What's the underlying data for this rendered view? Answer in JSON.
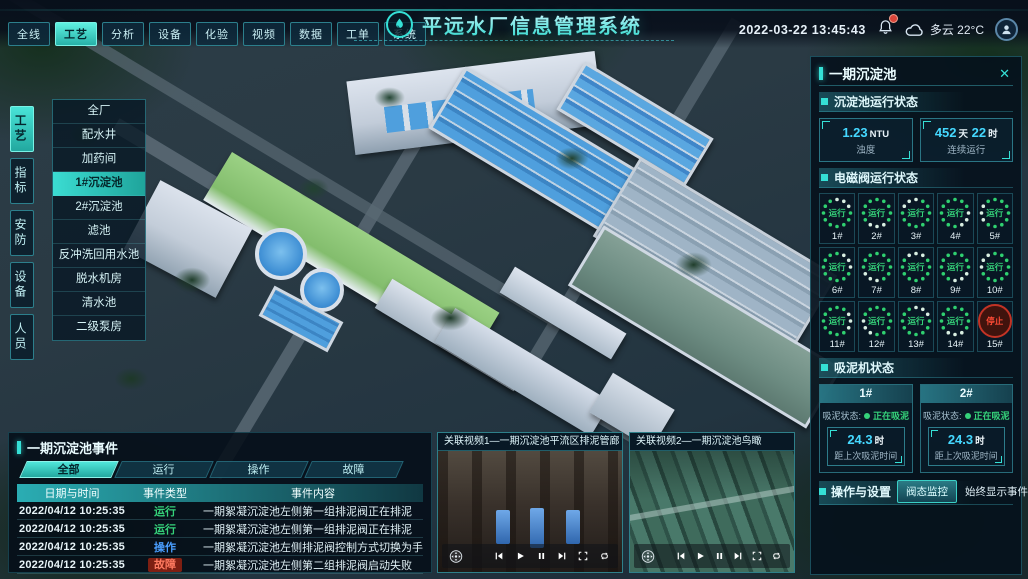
{
  "header": {
    "title": "平远水厂信息管理系统",
    "datetime": "2022-03-22 13:45:43",
    "weather": "多云 22°C",
    "nav_tabs": [
      {
        "label": "全线",
        "active": false
      },
      {
        "label": "工艺",
        "active": true
      },
      {
        "label": "分析",
        "active": false
      },
      {
        "label": "设备",
        "active": false
      },
      {
        "label": "化验",
        "active": false
      },
      {
        "label": "视频",
        "active": false
      },
      {
        "label": "数据",
        "active": false
      },
      {
        "label": "工单",
        "active": false
      },
      {
        "label": "系统",
        "active": false
      }
    ]
  },
  "sidebar": {
    "tabs": [
      {
        "label": "工艺",
        "active": true
      },
      {
        "label": "指标",
        "active": false
      },
      {
        "label": "安防",
        "active": false
      },
      {
        "label": "设备",
        "active": false
      },
      {
        "label": "人员",
        "active": false
      }
    ],
    "menu": [
      {
        "label": "全厂",
        "active": false
      },
      {
        "label": "配水井",
        "active": false
      },
      {
        "label": "加药间",
        "active": false
      },
      {
        "label": "1#沉淀池",
        "active": true
      },
      {
        "label": "2#沉淀池",
        "active": false
      },
      {
        "label": "滤池",
        "active": false
      },
      {
        "label": "反冲洗回用水池",
        "active": false
      },
      {
        "label": "脱水机房",
        "active": false
      },
      {
        "label": "清水池",
        "active": false
      },
      {
        "label": "二级泵房",
        "active": false
      }
    ]
  },
  "right_panel": {
    "title": "一期沉淀池",
    "close_glyph": "✕",
    "running_status": {
      "title": "沉淀池运行状态",
      "cards": [
        {
          "value": "1.23",
          "unit": "NTU",
          "label": "浊度"
        },
        {
          "value": "452",
          "unit": "天",
          "value2": "22",
          "unit2": "时",
          "label": "连续运行"
        }
      ]
    },
    "valves": {
      "title": "电磁阀运行状态",
      "items": [
        {
          "id": "1#",
          "status": "运行",
          "state": "running"
        },
        {
          "id": "2#",
          "status": "运行",
          "state": "running"
        },
        {
          "id": "3#",
          "status": "运行",
          "state": "running"
        },
        {
          "id": "4#",
          "status": "运行",
          "state": "running"
        },
        {
          "id": "5#",
          "status": "运行",
          "state": "running"
        },
        {
          "id": "6#",
          "status": "运行",
          "state": "running"
        },
        {
          "id": "7#",
          "status": "运行",
          "state": "running"
        },
        {
          "id": "8#",
          "status": "运行",
          "state": "running"
        },
        {
          "id": "9#",
          "status": "运行",
          "state": "running"
        },
        {
          "id": "10#",
          "status": "运行",
          "state": "running"
        },
        {
          "id": "11#",
          "status": "运行",
          "state": "running"
        },
        {
          "id": "12#",
          "status": "运行",
          "state": "running"
        },
        {
          "id": "13#",
          "status": "运行",
          "state": "running"
        },
        {
          "id": "14#",
          "status": "运行",
          "state": "running"
        },
        {
          "id": "15#",
          "status": "停止",
          "state": "stopped"
        }
      ]
    },
    "sludge": {
      "title": "吸泥机状态",
      "status_label": "吸泥状态:",
      "machines": [
        {
          "id": "1#",
          "status": "正在吸泥",
          "value": "24.3",
          "unit": "时",
          "caption": "距上次吸泥时间"
        },
        {
          "id": "2#",
          "status": "正在吸泥",
          "value": "24.3",
          "unit": "时",
          "caption": "距上次吸泥时间"
        }
      ]
    },
    "settings": {
      "title": "操作与设置",
      "button": "阀态监控",
      "toggle_label": "始终显示事件:",
      "toggle_on": true
    }
  },
  "events": {
    "title": "一期沉淀池事件",
    "tabs": [
      {
        "label": "全部",
        "active": true
      },
      {
        "label": "运行",
        "active": false
      },
      {
        "label": "操作",
        "active": false
      },
      {
        "label": "故障",
        "active": false
      }
    ],
    "columns": [
      "日期与时间",
      "事件类型",
      "事件内容"
    ],
    "rows": [
      {
        "datetime": "2022/04/12 10:25:35",
        "type": "运行",
        "type_class": "run",
        "content": "一期絮凝沉淀池左侧第一组排泥阀正在排泥"
      },
      {
        "datetime": "2022/04/12 10:25:35",
        "type": "运行",
        "type_class": "run",
        "content": "一期絮凝沉淀池左侧第一组排泥阀正在排泥"
      },
      {
        "datetime": "2022/04/12 10:25:35",
        "type": "操作",
        "type_class": "op",
        "content": "一期絮凝沉淀池左侧排泥阀控制方式切换为手动"
      },
      {
        "datetime": "2022/04/12 10:25:35",
        "type": "故障",
        "type_class": "fault",
        "content": "一期絮凝沉淀池左侧第二组排泥阀启动失败"
      }
    ]
  },
  "videos": [
    {
      "title": "关联视频1—一期沉淀池平流区排泥管廊"
    },
    {
      "title": "关联视频2—一期沉淀池鸟瞰"
    }
  ],
  "colors": {
    "accent": "#35e0d6",
    "running_green": "#35d27a",
    "operation_blue": "#4a9eff",
    "fault_red": "#ff5a43",
    "stop_red": "#c23325",
    "value_cyan": "#45d8ff"
  }
}
